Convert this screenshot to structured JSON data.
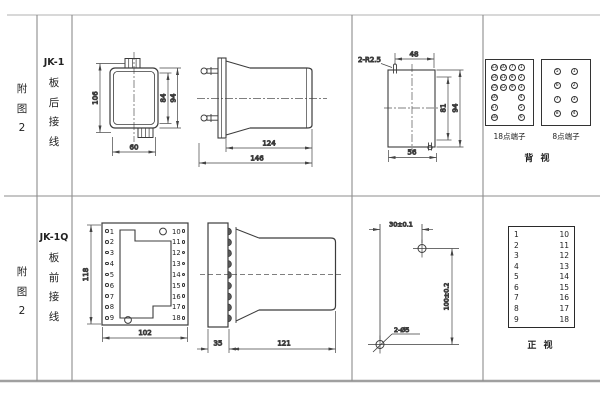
{
  "sidebar_top": {
    "figure": [
      "附",
      "图",
      "2"
    ],
    "model": "JK-1",
    "wiring": [
      "板",
      "后",
      "接",
      "线"
    ]
  },
  "sidebar_bottom": {
    "figure": [
      "附",
      "图",
      "2"
    ],
    "model": "JK-1Q",
    "wiring": [
      "板",
      "前",
      "接",
      "线"
    ]
  },
  "jk1_front": {
    "dim_height_total": "106",
    "dim_height_inner": "84",
    "dim_height_outer": "94",
    "dim_width": "60"
  },
  "jk1_side": {
    "dim_body": "124",
    "dim_total": "146"
  },
  "jk1_cutout": {
    "note_radius": "2-R2.5",
    "dim_top": "48",
    "dim_right_inner": "81",
    "dim_right_outer": "94",
    "dim_bottom": "56"
  },
  "back_panel": {
    "box18": {
      "label": "18点端子",
      "columns": [
        [
          "13",
          "14",
          "15",
          "16",
          "17",
          "18"
        ],
        [
          "10",
          "11",
          "12"
        ],
        [
          "7",
          "8",
          "9"
        ],
        [
          "1",
          "2",
          "3",
          "4",
          "5",
          "6"
        ]
      ]
    },
    "box8": {
      "label": "8点端子",
      "columns": [
        [
          "5",
          "6",
          "7",
          "8"
        ],
        [
          "1",
          "2",
          "3",
          "4"
        ]
      ]
    },
    "view_label": "背  视"
  },
  "jk1q_front": {
    "dim_height": "118",
    "dim_width": "102",
    "left_terminals": [
      "1",
      "2",
      "3",
      "4",
      "5",
      "6",
      "7",
      "8",
      "9"
    ],
    "right_terminals": [
      "10",
      "11",
      "12",
      "13",
      "14",
      "15",
      "16",
      "17",
      "18"
    ]
  },
  "jk1q_side": {
    "dim_plate": "35",
    "dim_body": "121"
  },
  "drill": {
    "dim_horizontal": "30±0.1",
    "dim_vertical": "100±0.2",
    "hole_note": "2-Ø5"
  },
  "front_table": {
    "left": [
      "1",
      "2",
      "3",
      "4",
      "5",
      "6",
      "7",
      "8",
      "9"
    ],
    "right": [
      "10",
      "11",
      "12",
      "13",
      "14",
      "15",
      "16",
      "17",
      "18"
    ],
    "view_label": "正  视"
  }
}
